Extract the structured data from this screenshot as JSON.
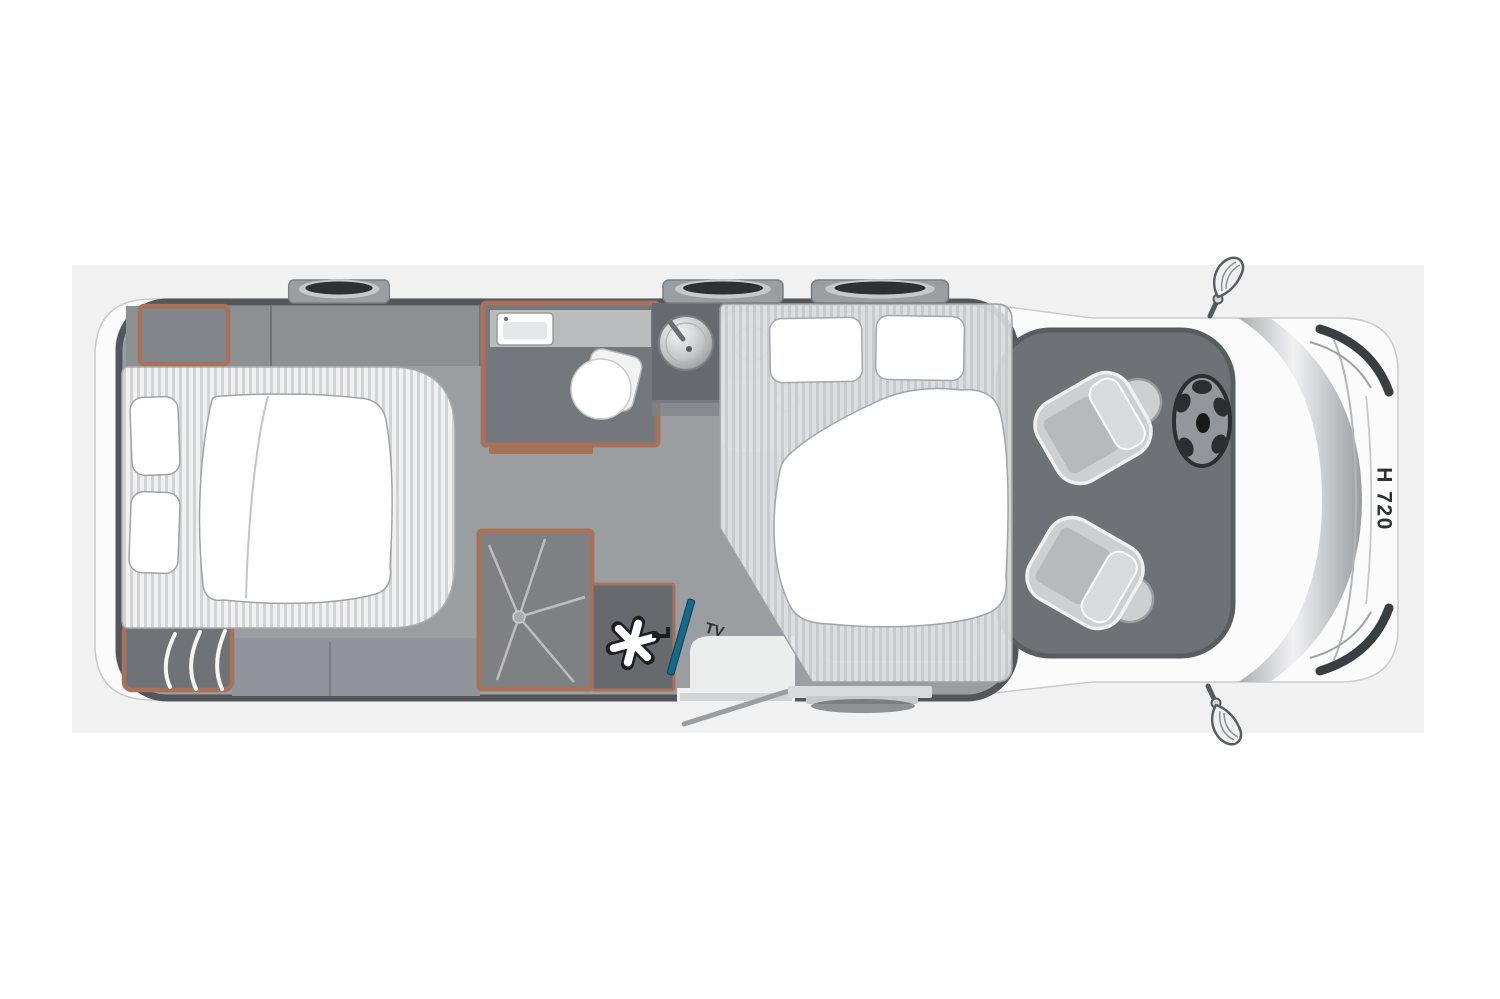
{
  "labels": {
    "model": "H 720",
    "tv": "TV"
  },
  "palette": {
    "page_bg": "#ffffff",
    "panel_bg": "#f1f1f2",
    "body_white": "#fbfbfc",
    "outline_dark": "#54575b",
    "floor_gray": "#9b9ea1",
    "locker_gray": "#8d9093",
    "bench_gray": "#91949a",
    "furniture_gray": "#74787c",
    "dark_unit": "#66696d",
    "lounge_gray": "#6e7276",
    "shower_gray": "#7e8184",
    "accent_brown": "#a8715a",
    "stripe_light": "#f1f1f2",
    "stripe_dark": "#d2d3d5",
    "seat_light": "#cdcfd1",
    "cushion_gray": "#b7b9bb",
    "tv_teal": "#156a88",
    "text_dark": "#2e3033",
    "white": "#ffffff"
  },
  "features": [
    "rear-island-bed",
    "rear-wardrobe-top",
    "rear-wardrobe-bottom",
    "washroom-with-basin-and-toilet",
    "shower-cabin",
    "heater-unit",
    "tv-mount",
    "kitchen-sink",
    "drop-down-bed",
    "lounge-area",
    "swivel-seat-passenger",
    "swivel-seat-driver",
    "steering-wheel",
    "roof-vent-1",
    "roof-vent-2",
    "roof-vent-3",
    "entry-door",
    "entry-step",
    "side-mirror-left",
    "side-mirror-right"
  ]
}
